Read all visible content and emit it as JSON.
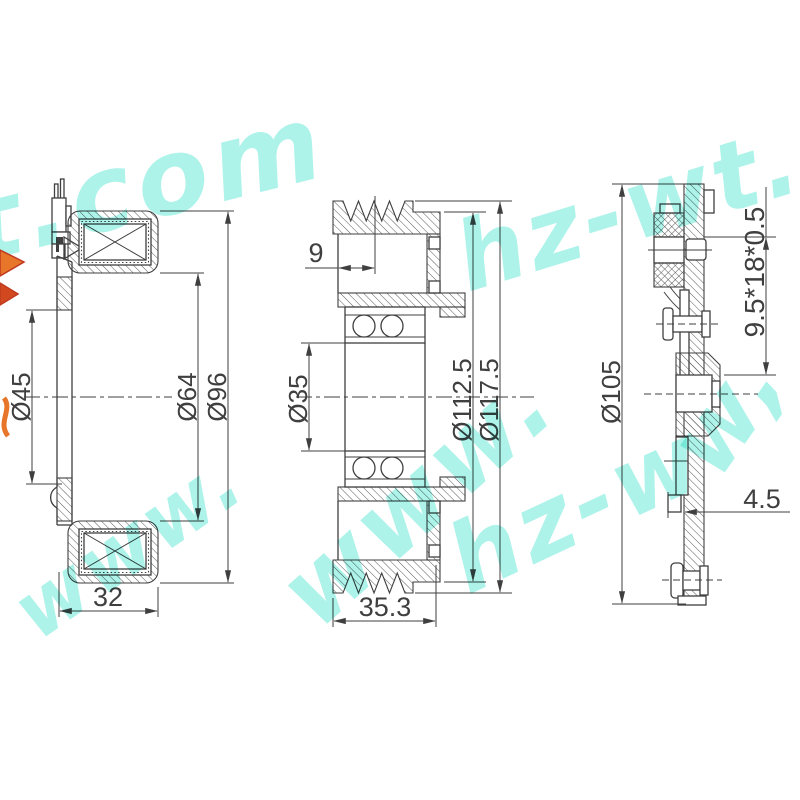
{
  "watermark": {
    "full_text": "www.hz-wt.com",
    "fragments": {
      "top_left": "t.com",
      "top_right": "hz-wt.",
      "mid_left": "www.",
      "center": "www.",
      "center_right": "hz-w",
      "right_edge": "w,"
    }
  },
  "views": {
    "coil_section": {
      "dimensions": {
        "bore": "Ø45",
        "inner": "Ø64",
        "outer": "Ø96",
        "width": "32"
      }
    },
    "pulley_section": {
      "dimensions": {
        "groove_offset": "9",
        "bearing_bore": "Ø35",
        "groove_root": "Ø112.5",
        "outer": "Ø117.5",
        "width": "35.3"
      }
    },
    "hub_plate_section": {
      "dimensions": {
        "damper_spec": "9.5*18*0.5",
        "outer": "Ø105",
        "plate_thickness": "4.5"
      }
    }
  },
  "colors": {
    "background": "#ffffff",
    "line": "#3f3f3f",
    "watermark": "#7becdd",
    "logo_orange": "#e8762a",
    "logo_red": "#c03a20"
  }
}
